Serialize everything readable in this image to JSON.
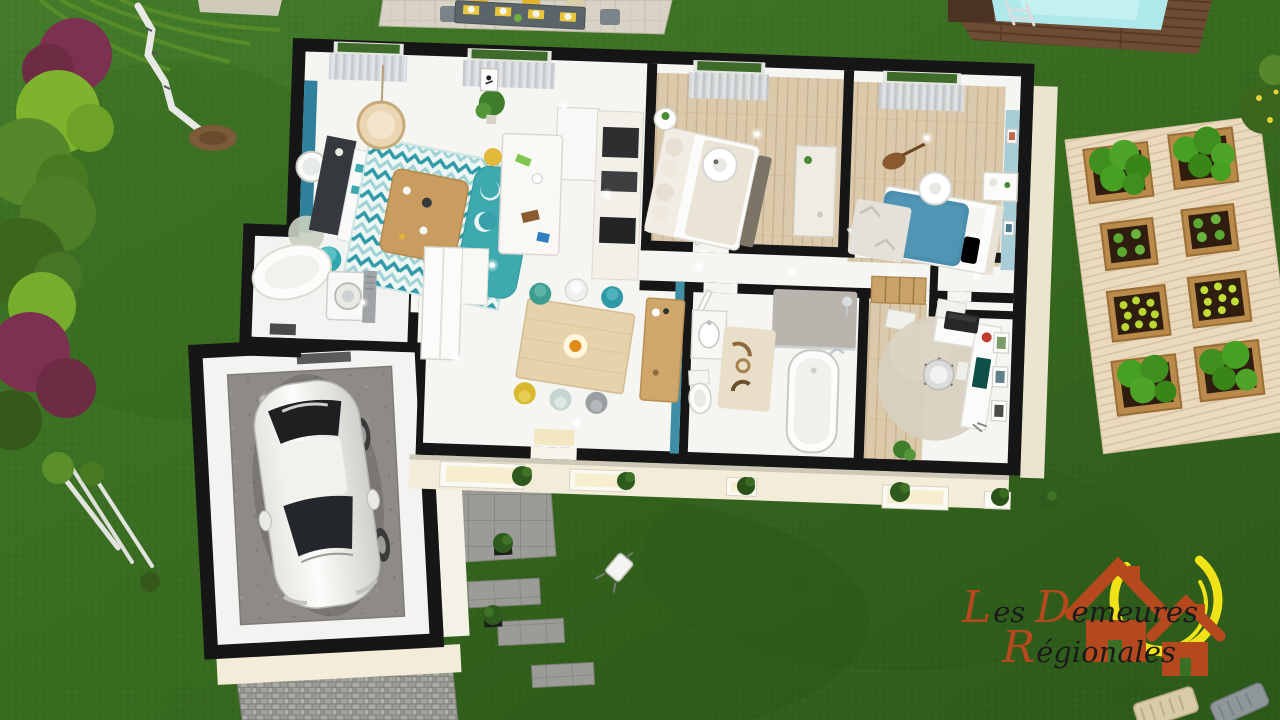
{
  "meta": {
    "description": "3D cutaway top-view rendering of a single-storey house floor plan on a lawn",
    "vendor_logo_visible": true
  },
  "logo": {
    "l1a": "L",
    "l1b": "es",
    "l1c": "D",
    "l1d": "emeures",
    "l2a": "R",
    "l2b": "égionales",
    "house_color": "#b5491d",
    "sun_color": "#efe317",
    "text_color": "#1b1b1b"
  },
  "palette": {
    "lawn_green": "#3a7024",
    "wall_black": "#161616",
    "facade_cream": "#f2ecd9",
    "accent_teal": "#2f819b",
    "wall_teal2": "#3e8ea5",
    "sofa_teal": "#3fa9b0",
    "bed_blue": "#4a8fae",
    "bedroom2_wall": "#a9cdd6",
    "wood_floor": "#dbc9ab",
    "pool_water": "#aee8ea",
    "pool_deck": "#6e4b33",
    "planter_wood": "#b98a4a",
    "driveway_gray": "#8c8d89"
  },
  "floor_plan": {
    "style": "3d-cutaway-top-view",
    "rooms": [
      {
        "name": "living-room",
        "accent_wall": "teal",
        "furniture": [
          "tv-unit",
          "teal-sofa",
          "coffee-table",
          "zigzag-rug",
          "hanging-rattan-chair",
          "round-mirror",
          "floor-lamp",
          "plant"
        ]
      },
      {
        "name": "kitchen",
        "furniture": [
          "island-with-stools",
          "counter-run",
          "tall-cabinets"
        ]
      },
      {
        "name": "dining-area",
        "furniture": [
          "dining-table",
          "six-chairs",
          "sideboard",
          "pendant-light"
        ]
      },
      {
        "name": "entry-hall",
        "furniture": [
          "wardrobe-closets",
          "front-door"
        ]
      },
      {
        "name": "laundry-room",
        "furniture": [
          "tub",
          "washing-machine"
        ]
      },
      {
        "name": "master-bedroom",
        "furniture": [
          "double-bed",
          "dresser",
          "round-side-table",
          "drum-pendant",
          "window-curtains"
        ]
      },
      {
        "name": "bedroom-2",
        "accent_wall": "light-blue",
        "furniture": [
          "blue-single-bed",
          "nightstand",
          "guitar",
          "rug",
          "drum-pendant",
          "wall-frames"
        ]
      },
      {
        "name": "hallway",
        "furniture": [
          "ceiling-lights"
        ]
      },
      {
        "name": "bathroom",
        "accent_wall": "teal",
        "furniture": [
          "bathtub",
          "shower",
          "toilet",
          "vanity",
          "patterned-rug"
        ]
      },
      {
        "name": "office",
        "furniture": [
          "l-desk",
          "office-chair",
          "monitor",
          "printer",
          "wood-wardrobe",
          "wall-frames",
          "fluffy-rug"
        ]
      },
      {
        "name": "wc"
      },
      {
        "name": "garage",
        "contents": [
          "white-car",
          "concrete-floor"
        ]
      }
    ]
  },
  "garden": {
    "features": [
      "lawn",
      "hedge-row-left",
      "birch-trees",
      "patio-dining-set",
      "swimming-pool",
      "pool-deck",
      "vegetable-garden-deck",
      "eight-planter-boxes",
      "cobblestone-driveway",
      "stone-terrace",
      "stepping-stones",
      "facade-shrubs",
      "toppled-garden-chair",
      "corner-lounge-chairs"
    ]
  },
  "vehicle": {
    "type": "hatchback-car",
    "color": "white"
  }
}
